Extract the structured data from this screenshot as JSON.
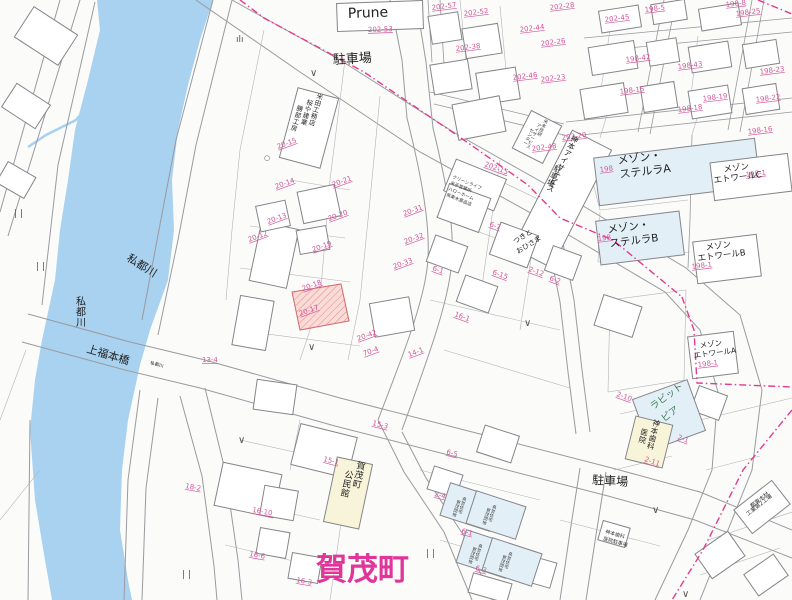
{
  "map": {
    "big_label": "賀茂町",
    "colors": {
      "river": "#a8d2f0",
      "boundary_pink": "#e23b8e",
      "parcel_number_pink": "#d4579b",
      "big_label_magenta": "#e0369c",
      "building_blue": "#e2eff7",
      "building_cream": "#f8f4d9",
      "highlight_parcel_fill": "#fadbd8",
      "highlight_parcel_stroke": "#d06a6a",
      "line_gray": "#9a9aa0",
      "green_label": "#3a7a52"
    },
    "place_labels": [
      {
        "t": "Prune",
        "x": 348,
        "y": 18,
        "s": 14,
        "r": -2,
        "c": "#222"
      },
      {
        "t": "202-53",
        "x": 368,
        "y": 32,
        "s": 7,
        "r": -2,
        "c": "#d4579b",
        "u": true
      },
      {
        "t": "駐車場",
        "x": 333,
        "y": 64,
        "s": 13,
        "r": -3,
        "c": "#222"
      },
      {
        "t": "駐車場",
        "x": 592,
        "y": 484,
        "s": 12,
        "r": 3,
        "c": "#222"
      },
      {
        "t": "私都川",
        "x": 126,
        "y": 260,
        "s": 11,
        "r": 32,
        "c": "#222"
      },
      {
        "t": "私都川",
        "x": 76,
        "y": 305,
        "s": 10,
        "r": 0,
        "c": "#222",
        "v": true
      },
      {
        "t": "私都川",
        "x": 150,
        "y": 364,
        "s": 4.5,
        "r": 16,
        "c": "#222"
      },
      {
        "t": "上福本橋",
        "x": 86,
        "y": 352,
        "s": 11,
        "r": 17,
        "c": "#222"
      },
      {
        "t": "賀茂町",
        "x": 316,
        "y": 580,
        "s": 31,
        "r": 0,
        "c": "#e0369c",
        "b": true
      },
      {
        "t": "賀茂町",
        "x": 356,
        "y": 468,
        "s": 9,
        "r": 12,
        "c": "#222",
        "v": true
      },
      {
        "t": "公民館",
        "x": 344,
        "y": 477,
        "s": 9,
        "r": 12,
        "c": "#222",
        "v": true
      },
      {
        "t": "神本歯科",
        "x": 652,
        "y": 425,
        "s": 7.5,
        "r": 14,
        "c": "#222",
        "v": true
      },
      {
        "t": "医院",
        "x": 640,
        "y": 434,
        "s": 7.5,
        "r": 14,
        "c": "#222",
        "v": true
      },
      {
        "t": "神本アイサービス",
        "x": 570,
        "y": 140,
        "s": 7.5,
        "r": 26,
        "c": "#222",
        "v": true
      },
      {
        "t": "駐車場",
        "x": 553,
        "y": 170,
        "s": 7.5,
        "r": 26,
        "c": "#222",
        "v": true
      },
      {
        "t": "米本技研",
        "x": 543,
        "y": 122,
        "s": 4.5,
        "r": 26,
        "c": "#333",
        "v": true
      },
      {
        "t": "アイサービス",
        "x": 536,
        "y": 126,
        "s": 4.5,
        "r": 26,
        "c": "#333",
        "v": true
      },
      {
        "t": "センター",
        "x": 529,
        "y": 131,
        "s": 4.5,
        "r": 26,
        "c": "#333",
        "v": true
      },
      {
        "t": "米田工務店",
        "x": 316,
        "y": 98,
        "s": 6.5,
        "r": 16,
        "c": "#222",
        "v": true
      },
      {
        "t": "桜や建業",
        "x": 306,
        "y": 104,
        "s": 6.5,
        "r": 16,
        "c": "#222",
        "v": true
      },
      {
        "t": "勝部工房",
        "x": 296,
        "y": 110,
        "s": 6.5,
        "r": 16,
        "c": "#222",
        "v": true
      },
      {
        "t": "クリーンライフ",
        "x": 452,
        "y": 178,
        "s": 4.5,
        "r": 22,
        "c": "#333"
      },
      {
        "t": "米子営業所",
        "x": 450,
        "y": 184,
        "s": 4.5,
        "r": 22,
        "c": "#333"
      },
      {
        "t": "ハローホーム",
        "x": 448,
        "y": 190,
        "s": 4.5,
        "r": 22,
        "c": "#333"
      },
      {
        "t": "県東木薬品店",
        "x": 446,
        "y": 196,
        "s": 4.5,
        "r": 22,
        "c": "#333"
      },
      {
        "t": "つきと",
        "x": 515,
        "y": 244,
        "s": 7,
        "r": -32,
        "c": "#222"
      },
      {
        "t": "おひさま",
        "x": 518,
        "y": 254,
        "s": 7,
        "r": -32,
        "c": "#222"
      },
      {
        "t": "ラビット",
        "x": 653,
        "y": 410,
        "s": 9.5,
        "r": -36,
        "c": "#3a7a52"
      },
      {
        "t": "ピア",
        "x": 664,
        "y": 422,
        "s": 9.5,
        "r": -36,
        "c": "#3a7a52"
      },
      {
        "t": "メゾン・",
        "x": 618,
        "y": 164,
        "s": 11,
        "r": -7,
        "c": "#222"
      },
      {
        "t": "ステルラA",
        "x": 620,
        "y": 178,
        "s": 11,
        "r": -7,
        "c": "#222"
      },
      {
        "t": "メゾン・",
        "x": 608,
        "y": 233,
        "s": 10.5,
        "r": -7,
        "c": "#222"
      },
      {
        "t": "ステルラB",
        "x": 610,
        "y": 247,
        "s": 10.5,
        "r": -7,
        "c": "#222"
      },
      {
        "t": "メゾン",
        "x": 724,
        "y": 172,
        "s": 8.5,
        "r": -7,
        "c": "#222"
      },
      {
        "t": "エトワールC",
        "x": 714,
        "y": 183,
        "s": 8.5,
        "r": -7,
        "c": "#222"
      },
      {
        "t": "メゾン",
        "x": 706,
        "y": 250,
        "s": 8.5,
        "r": -7,
        "c": "#222"
      },
      {
        "t": "エトワールB",
        "x": 698,
        "y": 261,
        "s": 8.5,
        "r": -7,
        "c": "#222"
      },
      {
        "t": "メゾン",
        "x": 700,
        "y": 348,
        "s": 7.5,
        "r": -7,
        "c": "#222"
      },
      {
        "t": "エトワールA",
        "x": 694,
        "y": 358,
        "s": 7.5,
        "r": -7,
        "c": "#222"
      },
      {
        "t": "県営住宅",
        "x": 462,
        "y": 500,
        "s": 4.2,
        "r": 18,
        "c": "#333",
        "v": true
      },
      {
        "t": "賀茂団地",
        "x": 456,
        "y": 503,
        "s": 4.2,
        "r": 18,
        "c": "#333",
        "v": true
      },
      {
        "t": "県営住宅",
        "x": 492,
        "y": 508,
        "s": 4.2,
        "r": 18,
        "c": "#333",
        "v": true
      },
      {
        "t": "賀茂団地",
        "x": 486,
        "y": 511,
        "s": 4.2,
        "r": 18,
        "c": "#333",
        "v": true
      },
      {
        "t": "県営住宅",
        "x": 478,
        "y": 547,
        "s": 4.2,
        "r": 18,
        "c": "#333",
        "v": true
      },
      {
        "t": "賀茂団地",
        "x": 472,
        "y": 550,
        "s": 4.2,
        "r": 18,
        "c": "#333",
        "v": true
      },
      {
        "t": "県営住宅",
        "x": 508,
        "y": 555,
        "s": 4.2,
        "r": 18,
        "c": "#333",
        "v": true
      },
      {
        "t": "賀茂団地",
        "x": 502,
        "y": 558,
        "s": 4.2,
        "r": 18,
        "c": "#333",
        "v": true
      },
      {
        "t": "神本歯科",
        "x": 605,
        "y": 533,
        "s": 5,
        "r": 16,
        "c": "#333"
      },
      {
        "t": "医院駐車場",
        "x": 603,
        "y": 540,
        "s": 5,
        "r": 16,
        "c": "#333"
      },
      {
        "t": "都東木材",
        "x": 752,
        "y": 508,
        "s": 5.5,
        "r": -38,
        "c": "#333"
      },
      {
        "t": "工業第2工場",
        "x": 748,
        "y": 516,
        "s": 5.5,
        "r": -38,
        "c": "#333"
      }
    ],
    "parcel_numbers": [
      {
        "t": "202-57",
        "x": 432,
        "y": 10,
        "r": -7
      },
      {
        "t": "202-52",
        "x": 464,
        "y": 16,
        "r": -7
      },
      {
        "t": "202-28",
        "x": 550,
        "y": 10,
        "r": -7
      },
      {
        "t": "198-5",
        "x": 645,
        "y": 12,
        "r": -7
      },
      {
        "t": "198-8",
        "x": 726,
        "y": 7,
        "r": -7
      },
      {
        "t": "198-25",
        "x": 736,
        "y": 16,
        "r": -7
      },
      {
        "t": "202-45",
        "x": 605,
        "y": 22,
        "r": -7
      },
      {
        "t": "202-44",
        "x": 520,
        "y": 32,
        "r": -7
      },
      {
        "t": "202-26",
        "x": 541,
        "y": 46,
        "r": -7
      },
      {
        "t": "202-38",
        "x": 456,
        "y": 51,
        "r": -7
      },
      {
        "t": "198-42",
        "x": 626,
        "y": 62,
        "r": -7
      },
      {
        "t": "198-43",
        "x": 678,
        "y": 69,
        "r": -7
      },
      {
        "t": "198-23",
        "x": 760,
        "y": 74,
        "r": -7
      },
      {
        "t": "202-46",
        "x": 513,
        "y": 80,
        "r": -7
      },
      {
        "t": "202-23",
        "x": 541,
        "y": 82,
        "r": -7
      },
      {
        "t": "198-15",
        "x": 620,
        "y": 94,
        "r": -7
      },
      {
        "t": "198-19",
        "x": 703,
        "y": 101,
        "r": -7
      },
      {
        "t": "198-22",
        "x": 756,
        "y": 102,
        "r": -7
      },
      {
        "t": "198-18",
        "x": 678,
        "y": 112,
        "r": -7
      },
      {
        "t": "198-16",
        "x": 748,
        "y": 134,
        "r": -7
      },
      {
        "t": "202-20",
        "x": 562,
        "y": 140,
        "r": -7
      },
      {
        "t": "202-48",
        "x": 532,
        "y": 151,
        "r": -7
      },
      {
        "t": "202-15",
        "x": 484,
        "y": 166,
        "r": 20
      },
      {
        "t": "198",
        "x": 600,
        "y": 172,
        "r": -7
      },
      {
        "t": "198-1",
        "x": 746,
        "y": 177,
        "r": -7
      },
      {
        "t": "198",
        "x": 598,
        "y": 241,
        "r": -7
      },
      {
        "t": "198-1",
        "x": 692,
        "y": 269,
        "r": -7
      },
      {
        "t": "198-1",
        "x": 698,
        "y": 367,
        "r": -7
      },
      {
        "t": "20-15",
        "x": 278,
        "y": 149,
        "r": -20
      },
      {
        "t": "20-14",
        "x": 276,
        "y": 189,
        "r": -20
      },
      {
        "t": "20-21",
        "x": 333,
        "y": 187,
        "r": -20
      },
      {
        "t": "20-13",
        "x": 268,
        "y": 224,
        "r": -20
      },
      {
        "t": "20-20",
        "x": 329,
        "y": 221,
        "r": -20
      },
      {
        "t": "20-12",
        "x": 249,
        "y": 242,
        "r": -20
      },
      {
        "t": "20-19",
        "x": 313,
        "y": 252,
        "r": -20
      },
      {
        "t": "20-31",
        "x": 404,
        "y": 216,
        "r": -20
      },
      {
        "t": "20-32",
        "x": 405,
        "y": 244,
        "r": -20
      },
      {
        "t": "20-33",
        "x": 394,
        "y": 269,
        "r": -20
      },
      {
        "t": "20-18",
        "x": 303,
        "y": 291,
        "r": -20
      },
      {
        "t": "20-17",
        "x": 300,
        "y": 316,
        "r": -20
      },
      {
        "t": "20-42",
        "x": 358,
        "y": 341,
        "r": -20
      },
      {
        "t": "70-4",
        "x": 364,
        "y": 356,
        "r": -20
      },
      {
        "t": "14-1",
        "x": 409,
        "y": 357,
        "r": -20
      },
      {
        "t": "13-4",
        "x": 202,
        "y": 362,
        "r": 0
      },
      {
        "t": "6-7",
        "x": 489,
        "y": 226,
        "r": 20
      },
      {
        "t": "6-1",
        "x": 432,
        "y": 270,
        "r": 20
      },
      {
        "t": "6-15",
        "x": 492,
        "y": 274,
        "r": 20
      },
      {
        "t": "2-12",
        "x": 528,
        "y": 271,
        "r": 20
      },
      {
        "t": "6-2",
        "x": 549,
        "y": 280,
        "r": 20
      },
      {
        "t": "16-1",
        "x": 454,
        "y": 316,
        "r": 20
      },
      {
        "t": "2-10",
        "x": 616,
        "y": 396,
        "r": 20
      },
      {
        "t": "2-1",
        "x": 677,
        "y": 439,
        "r": 20
      },
      {
        "t": "2-11",
        "x": 644,
        "y": 461,
        "r": 20
      },
      {
        "t": "15-3",
        "x": 372,
        "y": 425,
        "r": 14
      },
      {
        "t": "15-1",
        "x": 323,
        "y": 461,
        "r": 14
      },
      {
        "t": "6-5",
        "x": 446,
        "y": 454,
        "r": 14
      },
      {
        "t": "2-4",
        "x": 434,
        "y": 496,
        "r": 14
      },
      {
        "t": "6-1",
        "x": 461,
        "y": 533,
        "r": 14
      },
      {
        "t": "6-3",
        "x": 475,
        "y": 570,
        "r": 14
      },
      {
        "t": "18-2",
        "x": 185,
        "y": 488,
        "r": 10
      },
      {
        "t": "16-10",
        "x": 252,
        "y": 512,
        "r": 10
      },
      {
        "t": "16-6",
        "x": 249,
        "y": 556,
        "r": 10
      },
      {
        "t": "16-3",
        "x": 296,
        "y": 582,
        "r": 10
      }
    ],
    "symbols": [
      {
        "g": "∨",
        "x": 308,
        "y": 350,
        "s": 10
      },
      {
        "g": "∨",
        "x": 238,
        "y": 443,
        "s": 10
      },
      {
        "g": "∨",
        "x": 652,
        "y": 513,
        "s": 10
      },
      {
        "g": "∨",
        "x": 682,
        "y": 597,
        "s": 10
      },
      {
        "g": "∨",
        "x": 310,
        "y": 76,
        "s": 10
      },
      {
        "g": "∨",
        "x": 524,
        "y": 326,
        "s": 10
      },
      {
        "g": "| |",
        "x": 14,
        "y": 216,
        "s": 9
      },
      {
        "g": "| |",
        "x": 36,
        "y": 269,
        "s": 9
      },
      {
        "g": "| |",
        "x": 182,
        "y": 577,
        "s": 9
      },
      {
        "g": "| |",
        "x": 426,
        "y": 556,
        "s": 9
      },
      {
        "g": "ılı",
        "x": 236,
        "y": 42,
        "s": 9
      },
      {
        "g": "○",
        "x": 264,
        "y": 160,
        "s": 7
      }
    ]
  }
}
